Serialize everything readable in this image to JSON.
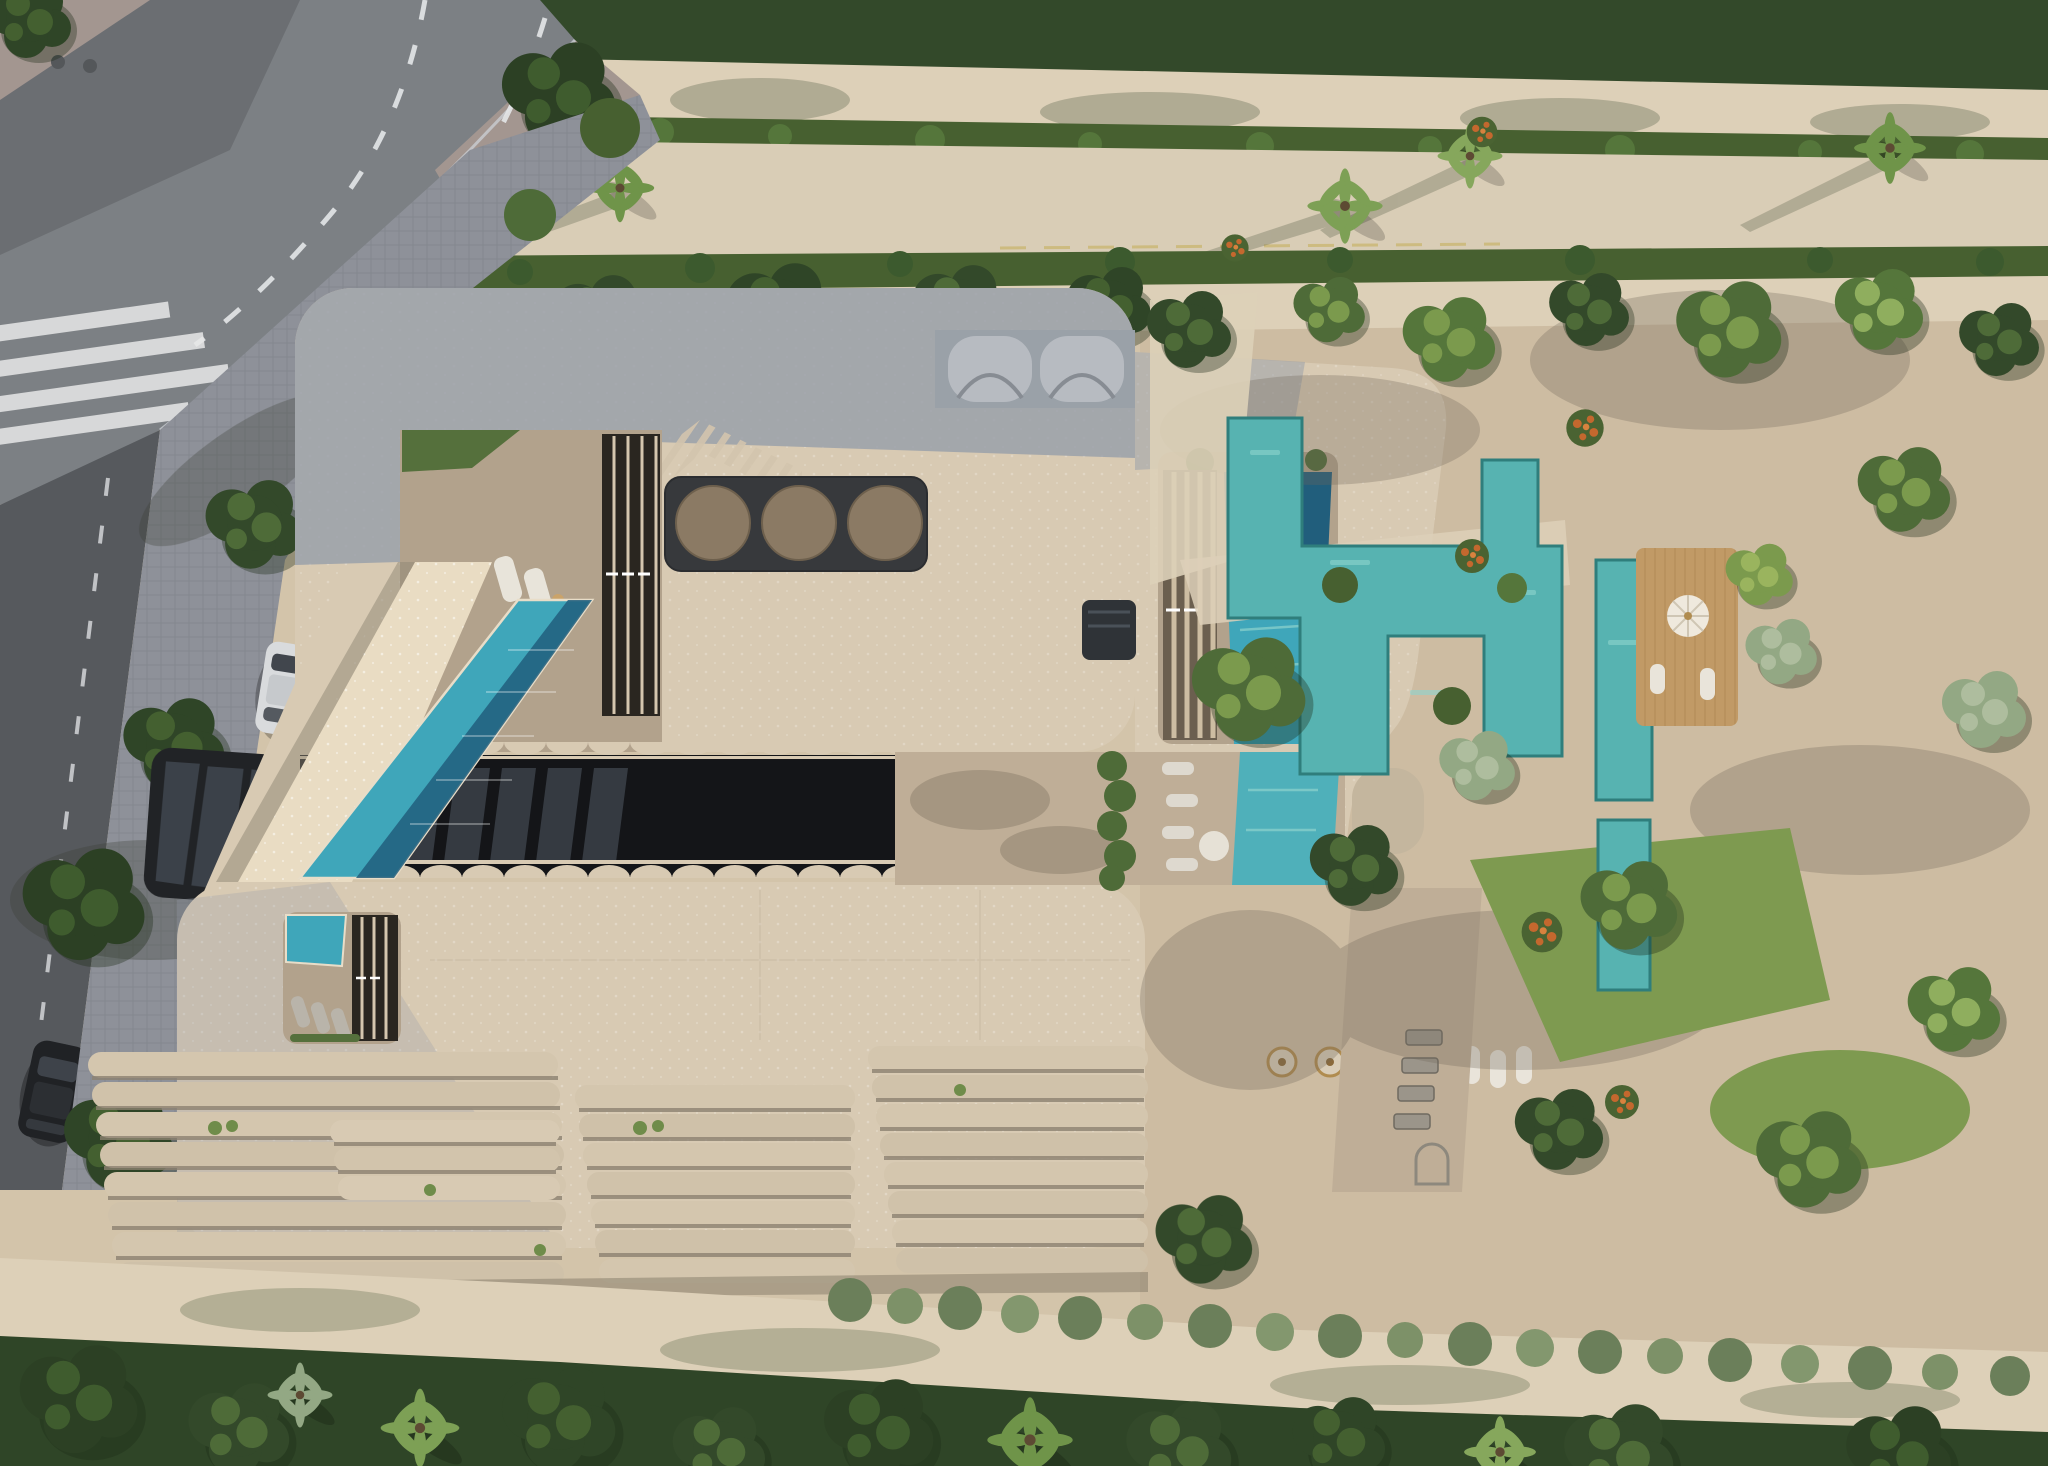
{
  "image": {
    "type": "aerial architectural rendering",
    "view": "top-down drone view",
    "subject": "curved beige resort-style residential building with rooftop pools, glass atrium, terraced balconies, landscaped water gardens and tree-lined streets",
    "width_px": 2048,
    "height_px": 1466
  },
  "palette": {
    "sand": "#d3c4aa",
    "sand2": "#cdbca2",
    "sand_light": "#ddd0b8",
    "asphalt": "#7c8084",
    "asphalt_dark": "#56595d",
    "lane": "#e4e6e8",
    "curb": "#c9cdd2",
    "paver": "#8e9199",
    "paver_pink": "#a39690",
    "beige": "#d8cab3",
    "beige_dark": "#c4b69e",
    "beige_bright": "#e9dcc3",
    "roof_shadow": "#969ea9",
    "stone": "#b2a28c",
    "stone2": "#bfae97",
    "glass_dark": "#212326",
    "glass_pane": "#3b4149",
    "louver_dark": "#2a2620",
    "panel_dark": "#37393c",
    "panel_circle": "#8b7a64",
    "pool_teal": "#3fa6ba",
    "pool_deep": "#215e7c",
    "water_teal": "#57b3b1",
    "deck_wood": "#c19a66",
    "lawn": "#7e9a50",
    "lawn_dark": "#55703c",
    "hedge": "#476030",
    "tree_dark": "#33492a",
    "tree_mid": "#4e6b38",
    "tree_light": "#7b9a4d",
    "tree_sage": "#93a884",
    "flower_orange": "#c4682e",
    "car_white": "#d9dbdd",
    "car_black": "#202225",
    "bench_gray": "#9b958a"
  },
  "scene": {
    "roads": {
      "intersection_position": "top-left",
      "lane_markings": "white dashed",
      "crosswalk_stripes": 4,
      "boulevard": "sand-colored avenue lined with palms and hedges across the top"
    },
    "vehicles": [
      {
        "name": "white-car",
        "location": "paver driveway left of building"
      },
      {
        "name": "dark-car",
        "location": "left road lower edge"
      }
    ],
    "building": {
      "wings": 2,
      "right_connector_arm": true,
      "rooftop_pools": 4,
      "lap_pool_bridge": 1,
      "louver_banks": 4,
      "feature_panel_circles": 3,
      "scalloped_balcony_pods": 2,
      "glass_atrium": true,
      "terraced_balcony_clusters": 4,
      "entrance_canopy": "dark glass",
      "hatched_roof_chevron": true
    },
    "amenities": {
      "sun_loungers": true,
      "round_tables": 2,
      "benches": 4,
      "wooden_deck": true,
      "garden_water_channels": true,
      "parasol": true
    },
    "vegetation": {
      "palms": true,
      "hedges": true,
      "orange_flowering_shrubs": true,
      "lawns": true,
      "dense_tree_band_bottom": true
    }
  }
}
